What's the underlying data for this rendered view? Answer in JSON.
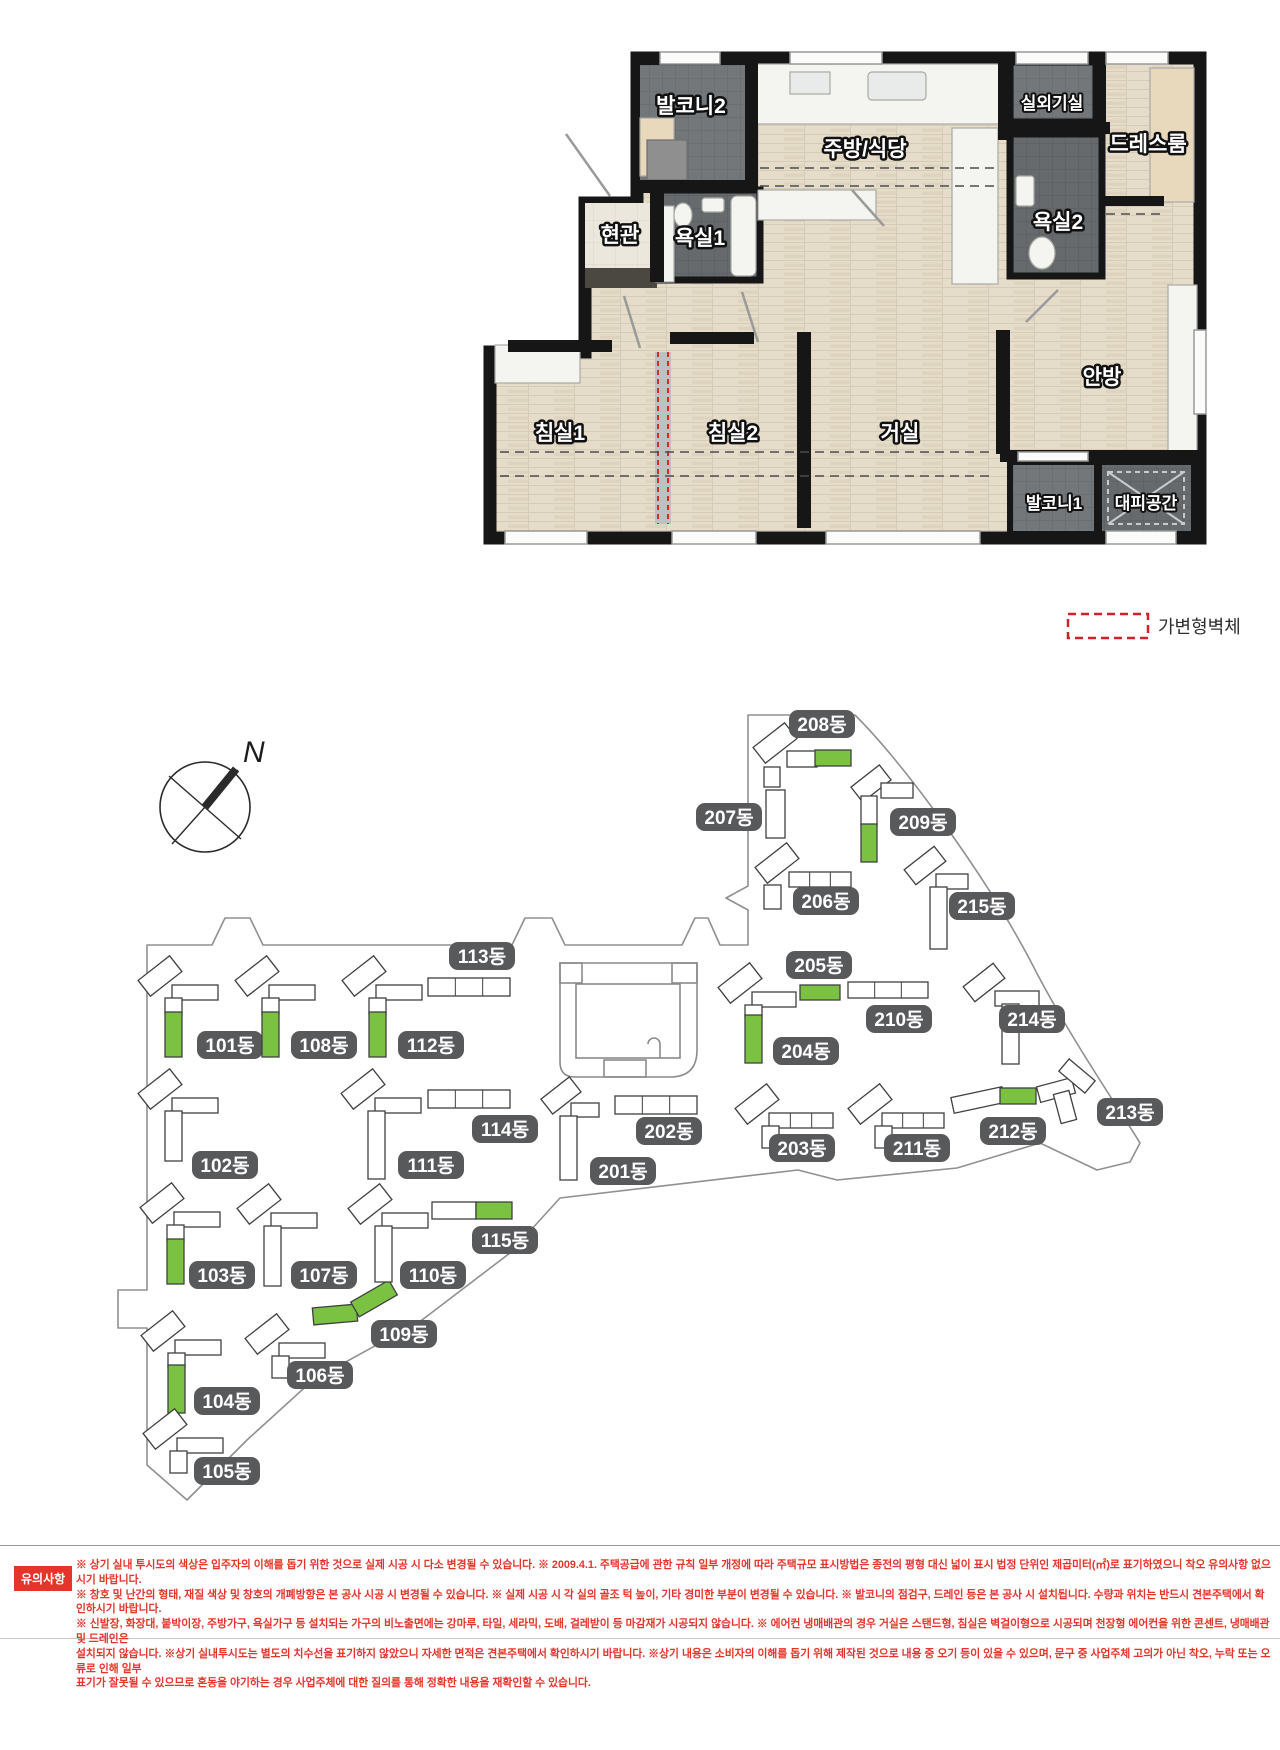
{
  "legend": {
    "label": "가변형벽체"
  },
  "floor_plan": {
    "rooms": {
      "balcony2": "발코니2",
      "kitchen": "주방/식당",
      "outdoor_unit": "실외기실",
      "dressroom": "드레스룸",
      "entrance": "현관",
      "bath1": "욕실1",
      "bath2": "욕실2",
      "bedroom1": "침실1",
      "bedroom2": "침실2",
      "living": "거실",
      "master": "안방",
      "balcony1": "발코니1",
      "shelter": "대피공간"
    }
  },
  "site_plan": {
    "north_label": "N",
    "colors": {
      "green": "#7CC242",
      "label_bg": "#58595B",
      "outline": "#3F4040",
      "boundary": "#8F9091"
    },
    "buildings": [
      {
        "id": "101",
        "label": "101동",
        "lx": 230,
        "ly": 1045,
        "parts": [
          [
            140,
            966,
            40,
            20,
            -38,
            "w"
          ],
          [
            172,
            985,
            46,
            15,
            0,
            "w"
          ],
          [
            165,
            998,
            17,
            16,
            0,
            "w"
          ],
          [
            165,
            1012,
            17,
            45,
            0,
            "g"
          ]
        ]
      },
      {
        "id": "102",
        "label": "102동",
        "lx": 225,
        "ly": 1165,
        "parts": [
          [
            140,
            1079,
            40,
            20,
            -38,
            "w"
          ],
          [
            172,
            1098,
            46,
            15,
            0,
            "w"
          ],
          [
            165,
            1111,
            17,
            50,
            0,
            "w"
          ]
        ]
      },
      {
        "id": "103",
        "label": "103동",
        "lx": 222,
        "ly": 1275,
        "parts": [
          [
            142,
            1193,
            40,
            20,
            -38,
            "w"
          ],
          [
            174,
            1212,
            46,
            15,
            0,
            "w"
          ],
          [
            167,
            1225,
            17,
            16,
            0,
            "w"
          ],
          [
            167,
            1239,
            17,
            45,
            0,
            "g"
          ]
        ]
      },
      {
        "id": "104",
        "label": "104동",
        "lx": 227,
        "ly": 1401,
        "parts": [
          [
            143,
            1321,
            40,
            20,
            -38,
            "w"
          ],
          [
            175,
            1340,
            46,
            15,
            0,
            "w"
          ],
          [
            168,
            1353,
            17,
            14,
            0,
            "w"
          ],
          [
            168,
            1365,
            17,
            48,
            0,
            "g"
          ]
        ]
      },
      {
        "id": "105",
        "label": "105동",
        "lx": 227,
        "ly": 1471,
        "parts": [
          [
            145,
            1419,
            40,
            20,
            -38,
            "w"
          ],
          [
            177,
            1438,
            46,
            15,
            0,
            "w"
          ],
          [
            170,
            1451,
            17,
            22,
            0,
            "w"
          ]
        ]
      },
      {
        "id": "106",
        "label": "106동",
        "lx": 320,
        "ly": 1375,
        "parts": [
          [
            247,
            1324,
            40,
            20,
            -38,
            "w"
          ],
          [
            279,
            1343,
            46,
            15,
            0,
            "w"
          ],
          [
            272,
            1356,
            17,
            22,
            0,
            "w"
          ]
        ]
      },
      {
        "id": "107",
        "label": "107동",
        "lx": 324,
        "ly": 1275,
        "parts": [
          [
            239,
            1194,
            40,
            20,
            -38,
            "w"
          ],
          [
            271,
            1213,
            46,
            15,
            0,
            "w"
          ],
          [
            264,
            1226,
            17,
            60,
            0,
            "w"
          ]
        ]
      },
      {
        "id": "108",
        "label": "108동",
        "lx": 324,
        "ly": 1045,
        "parts": [
          [
            237,
            966,
            40,
            20,
            -38,
            "w"
          ],
          [
            269,
            985,
            46,
            15,
            0,
            "w"
          ],
          [
            262,
            998,
            17,
            16,
            0,
            "w"
          ],
          [
            262,
            1012,
            17,
            45,
            0,
            "g"
          ]
        ]
      },
      {
        "id": "109",
        "label": "109동",
        "lx": 404,
        "ly": 1334,
        "parts": [
          [
            313,
            1306,
            44,
            17,
            -5,
            "g"
          ],
          [
            352,
            1290,
            44,
            17,
            -30,
            "g"
          ]
        ]
      },
      {
        "id": "110",
        "label": "110동",
        "lx": 433,
        "ly": 1275,
        "parts": [
          [
            350,
            1194,
            40,
            20,
            -38,
            "w"
          ],
          [
            382,
            1213,
            46,
            15,
            0,
            "w"
          ],
          [
            375,
            1226,
            17,
            56,
            0,
            "w"
          ]
        ]
      },
      {
        "id": "111",
        "label": "111동",
        "lx": 431,
        "ly": 1165,
        "parts": [
          [
            343,
            1079,
            40,
            20,
            -38,
            "w"
          ],
          [
            375,
            1098,
            46,
            15,
            0,
            "w"
          ],
          [
            368,
            1111,
            17,
            68,
            0,
            "w"
          ]
        ]
      },
      {
        "id": "112",
        "label": "112동",
        "lx": 431,
        "ly": 1045,
        "parts": [
          [
            344,
            966,
            40,
            20,
            -38,
            "w"
          ],
          [
            376,
            985,
            46,
            15,
            0,
            "w"
          ],
          [
            369,
            998,
            17,
            16,
            0,
            "w"
          ],
          [
            369,
            1012,
            17,
            45,
            0,
            "g"
          ]
        ]
      },
      {
        "id": "113",
        "label": "113동",
        "lx": 482,
        "ly": 956,
        "parts": [
          [
            428,
            978,
            82,
            18,
            0,
            "w"
          ]
        ]
      },
      {
        "id": "114",
        "label": "114동",
        "lx": 505,
        "ly": 1129,
        "parts": [
          [
            428,
            1090,
            82,
            18,
            0,
            "w"
          ]
        ]
      },
      {
        "id": "115",
        "label": "115동",
        "lx": 505,
        "ly": 1240,
        "parts": [
          [
            432,
            1202,
            44,
            17,
            0,
            "w"
          ],
          [
            476,
            1202,
            36,
            17,
            0,
            "g"
          ]
        ]
      },
      {
        "id": "201",
        "label": "201동",
        "lx": 623,
        "ly": 1171,
        "parts": [
          [
            543,
            1086,
            36,
            19,
            -38,
            "w"
          ],
          [
            571,
            1103,
            28,
            14,
            0,
            "w"
          ],
          [
            560,
            1116,
            17,
            64,
            0,
            "w"
          ]
        ]
      },
      {
        "id": "202",
        "label": "202동",
        "lx": 669,
        "ly": 1131,
        "parts": [
          [
            615,
            1096,
            82,
            18,
            0,
            "w"
          ]
        ]
      },
      {
        "id": "203",
        "label": "203동",
        "lx": 802,
        "ly": 1148,
        "parts": [
          [
            737,
            1094,
            40,
            20,
            -38,
            "w"
          ],
          [
            769,
            1113,
            64,
            15,
            0,
            "w"
          ],
          [
            762,
            1126,
            17,
            22,
            0,
            "w"
          ]
        ]
      },
      {
        "id": "204",
        "label": "204동",
        "lx": 806,
        "ly": 1051,
        "parts": [
          [
            720,
            973,
            40,
            20,
            -38,
            "w"
          ],
          [
            752,
            992,
            44,
            15,
            0,
            "w"
          ],
          [
            745,
            1005,
            17,
            12,
            0,
            "w"
          ],
          [
            745,
            1015,
            17,
            48,
            0,
            "g"
          ]
        ]
      },
      {
        "id": "205",
        "label": "205동",
        "lx": 819,
        "ly": 965,
        "parts": [
          [
            800,
            985,
            40,
            15,
            0,
            "g"
          ]
        ]
      },
      {
        "id": "206",
        "label": "206동",
        "lx": 826,
        "ly": 901,
        "parts": [
          [
            757,
            853,
            40,
            20,
            -38,
            "w"
          ],
          [
            789,
            872,
            62,
            15,
            0,
            "w"
          ],
          [
            764,
            885,
            17,
            24,
            0,
            "w"
          ]
        ]
      },
      {
        "id": "207",
        "label": "207동",
        "lx": 729,
        "ly": 817,
        "parts": [
          [
            766,
            790,
            19,
            48,
            0,
            "w"
          ]
        ]
      },
      {
        "id": "208",
        "label": "208동",
        "lx": 822,
        "ly": 724,
        "parts": [
          [
            755,
            733,
            40,
            20,
            -38,
            "w"
          ],
          [
            787,
            751,
            30,
            16,
            0,
            "w"
          ],
          [
            815,
            750,
            36,
            16,
            0,
            "g"
          ],
          [
            764,
            767,
            16,
            20,
            0,
            "w"
          ]
        ]
      },
      {
        "id": "209",
        "label": "209동",
        "lx": 923,
        "ly": 822,
        "parts": [
          [
            853,
            774,
            36,
            19,
            -38,
            "w"
          ],
          [
            881,
            783,
            32,
            15,
            0,
            "w"
          ],
          [
            861,
            796,
            16,
            30,
            0,
            "w"
          ],
          [
            861,
            824,
            16,
            38,
            0,
            "g"
          ]
        ]
      },
      {
        "id": "210",
        "label": "210동",
        "lx": 899,
        "ly": 1019,
        "parts": [
          [
            848,
            982,
            80,
            16,
            0,
            "w"
          ]
        ]
      },
      {
        "id": "211",
        "label": "211동",
        "lx": 917,
        "ly": 1148,
        "parts": [
          [
            850,
            1094,
            40,
            20,
            -38,
            "w"
          ],
          [
            882,
            1113,
            62,
            15,
            0,
            "w"
          ],
          [
            875,
            1126,
            17,
            22,
            0,
            "w"
          ]
        ]
      },
      {
        "id": "212",
        "label": "212동",
        "lx": 1013,
        "ly": 1131,
        "parts": [
          [
            952,
            1092,
            52,
            16,
            -12,
            "w"
          ],
          [
            1000,
            1088,
            36,
            16,
            0,
            "g"
          ]
        ]
      },
      {
        "id": "213",
        "label": "213동",
        "lx": 1130,
        "ly": 1112,
        "parts": [
          [
            1038,
            1082,
            36,
            16,
            -15,
            "w"
          ],
          [
            1060,
            1068,
            34,
            16,
            40,
            "w"
          ],
          [
            1057,
            1092,
            16,
            30,
            -15,
            "w"
          ]
        ]
      },
      {
        "id": "214",
        "label": "214동",
        "lx": 1032,
        "ly": 1019,
        "parts": [
          [
            965,
            973,
            38,
            19,
            -38,
            "w"
          ],
          [
            995,
            991,
            44,
            15,
            0,
            "w"
          ],
          [
            1002,
            1004,
            17,
            60,
            0,
            "w"
          ]
        ]
      },
      {
        "id": "215",
        "label": "215동",
        "lx": 982,
        "ly": 906,
        "parts": [
          [
            906,
            856,
            38,
            19,
            -38,
            "w"
          ],
          [
            936,
            874,
            32,
            15,
            0,
            "w"
          ],
          [
            930,
            887,
            17,
            62,
            0,
            "w"
          ]
        ]
      }
    ]
  },
  "notice": {
    "title": "유의사항",
    "lines": [
      "※ 상기 실내 투시도의 색상은 입주자의 이해를 돕기 위한 것으로 실제 시공 시 다소 변경될 수 있습니다. ※ 2009.4.1. 주택공급에 관한 규칙 일부 개정에 따라 주택규모 표시방법은 종전의 평형 대신 넓이 표시 법정 단위인 제곱미터(㎡)로 표기하였으니 착오 유의사항 없으시기 바랍니다.",
      "※ 창호 및 난간의 형태, 재질 색상 및 창호의 개폐방향은 본 공사 시공 시 변경될 수 있습니다. ※ 실제 시공 시 각 실의 골조 턱 높이, 기타 경미한 부분이 변경될 수 있습니다. ※ 발코니의 점검구, 드레인 등은 본 공사 시 설치됩니다. 수량과 위치는 반드시 견본주택에서 확인하시기 바랍니다.",
      "※ 신발장, 화장대, 붙박이장, 주방가구, 욕실가구 등 설치되는 가구의 비노출면에는 강마루, 타일, 세라믹, 도배, 걸레받이 등 마감재가 시공되지 않습니다. ※ 에어컨 냉매배관의 경우 거실은 스탠드형, 침실은 벽걸이형으로 시공되며 천장형 에어컨을 위한 콘센트, 냉매배관 및 드레인은",
      "설치되지 않습니다. ※상기 실내투시도는 별도의 치수선을 표기하지 않았으니 자세한 면적은 견본주택에서 확인하시기 바랍니다. ※상기 내용은 소비자의 이해를 돕기 위해 제작된 것으로 내용 중 오기 등이 있을 수 있으며, 문구 중 사업주체 고의가 아닌 착오, 누락 또는 오류로 인해 일부",
      "표기가 잘못될 수 있으므로 혼동을 야기하는 경우 사업주체에 대한 질의를 통해 정확한 내용을 재확인할 수 있습니다."
    ]
  }
}
